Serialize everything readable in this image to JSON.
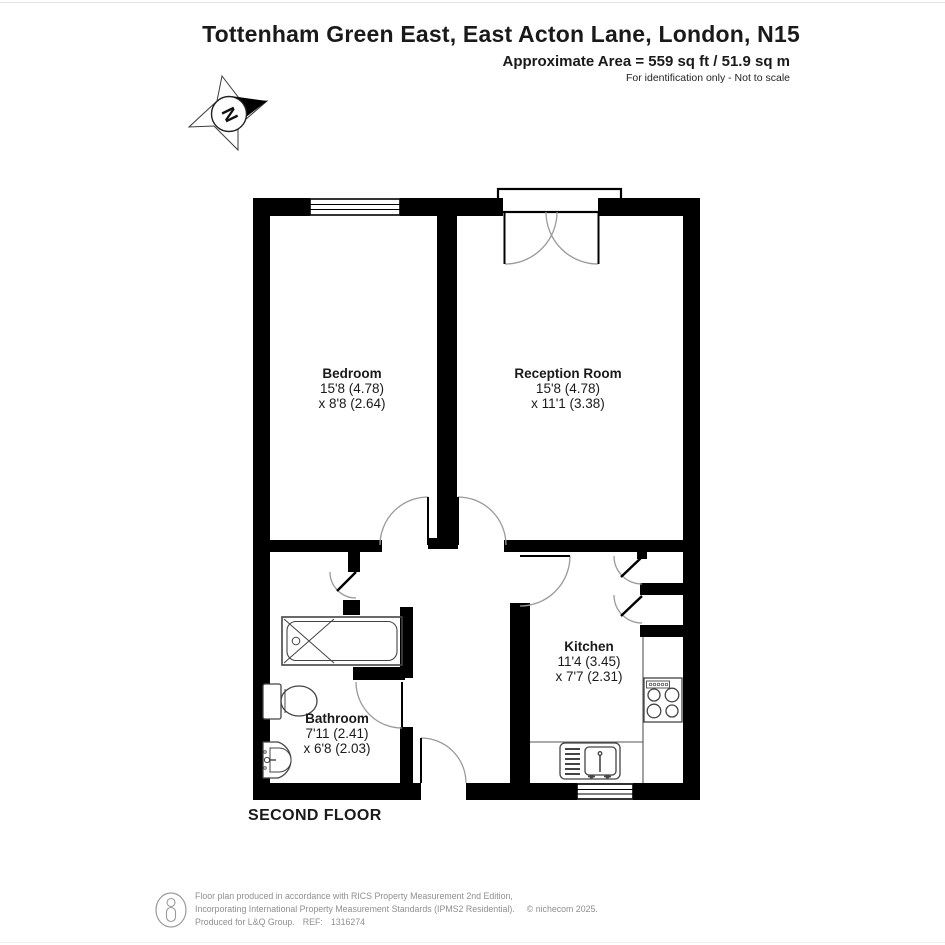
{
  "header": {
    "title": "Tottenham Green East, East Acton Lane, London, N15",
    "area_line": "Approximate Area = 559 sq ft / 51.9 sq m",
    "disclaimer": "For identification only - Not to scale"
  },
  "compass": {
    "north_label": "N"
  },
  "rooms": [
    {
      "name": "Bedroom",
      "dim1": "15'8 (4.78)",
      "dim2": "x 8'8 (2.64)"
    },
    {
      "name": "Reception Room",
      "dim1": "15'8 (4.78)",
      "dim2": "x 11'1 (3.38)"
    },
    {
      "name": "Kitchen",
      "dim1": "11'4 (3.45)",
      "dim2": "x 7'7 (2.31)"
    },
    {
      "name": "Bathroom",
      "dim1": "7'11 (2.41)",
      "dim2": "x 6'8 (2.03)"
    }
  ],
  "floor_label": "SECOND FLOOR",
  "footer": {
    "line1": "Floor plan produced in accordance with RICS Property Measurement 2nd Edition,",
    "line2": "Incorporating International Property Measurement Standards (IPMS2 Residential).",
    "copyright": "© nichecom 2025.",
    "produced_for": "Produced for L&Q Group.",
    "ref_label": "REF:",
    "ref_value": "1316274"
  },
  "colors": {
    "wall": "#000000",
    "door_arc": "#9a9a9a",
    "fixture_line": "#444444",
    "footer_text": "#8f8f8f"
  }
}
